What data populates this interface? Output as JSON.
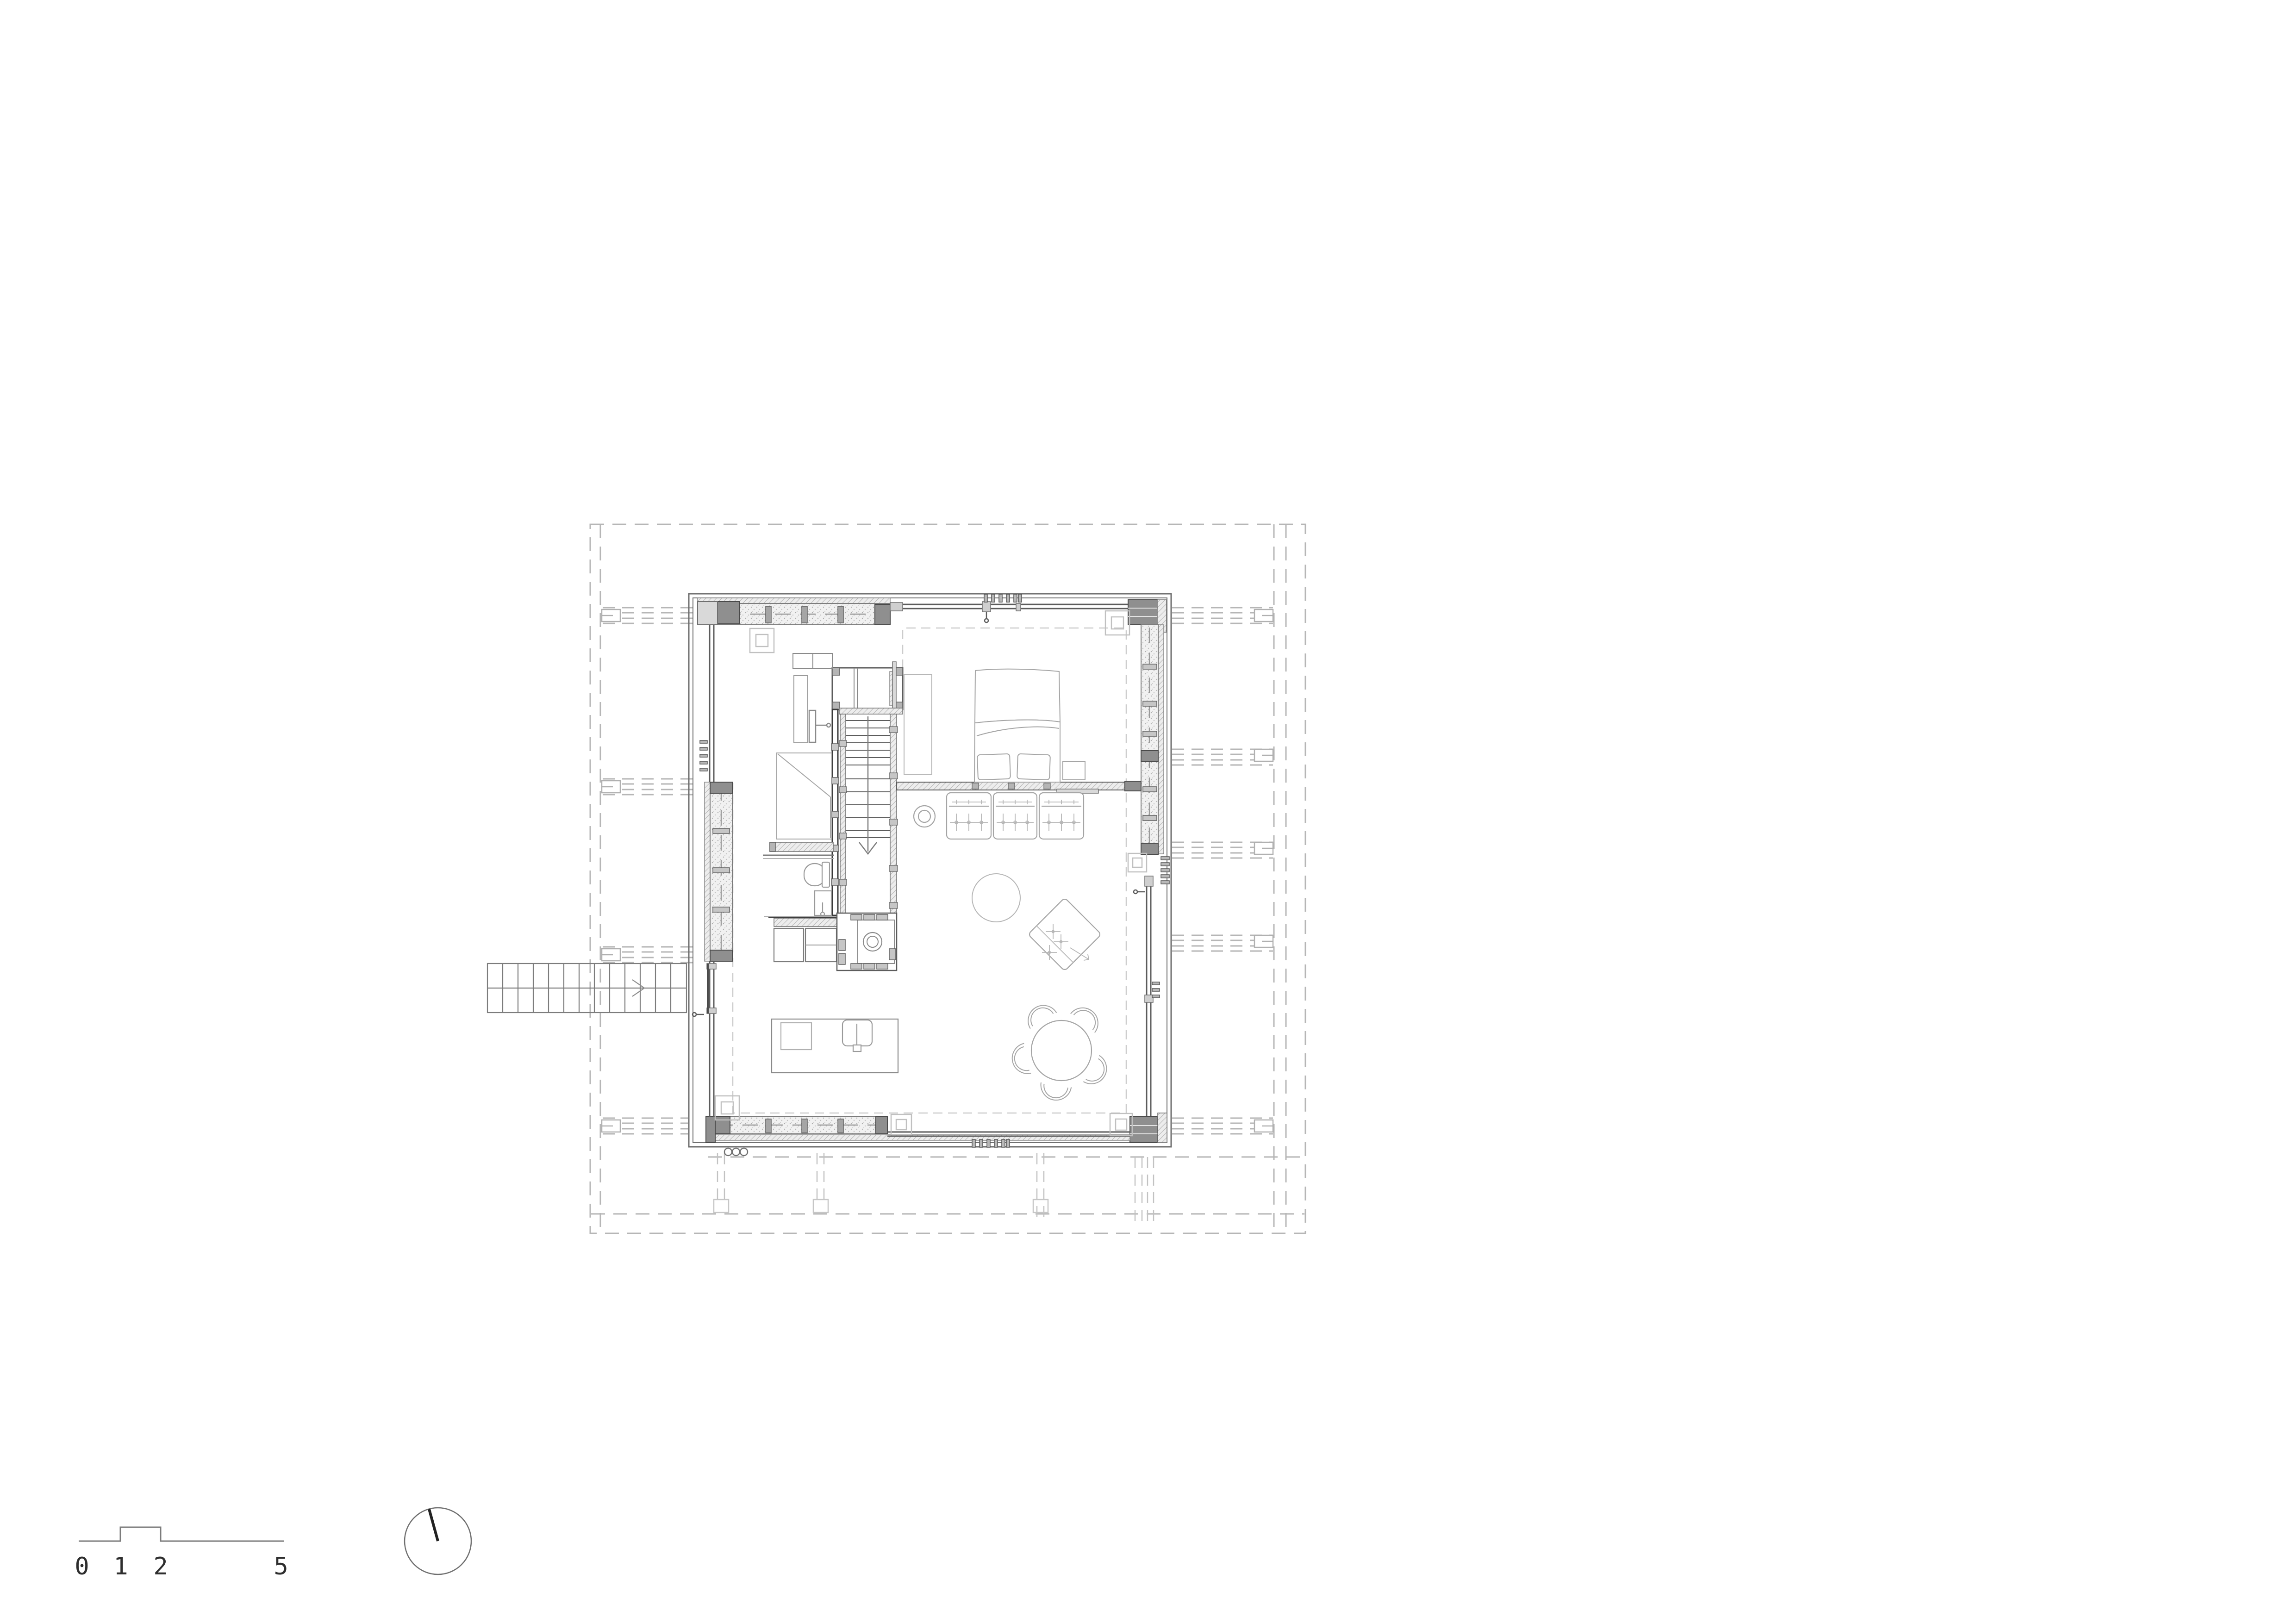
{
  "document": {
    "type": "architectural-floor-plan",
    "background": "#ffffff",
    "description": "Single-storey timber house floor plan with central stair core, bathroom block, two bed areas, sofa, dining table, masonry stove, external entry stair, dashed roof/foundation grid, scale bar and north indicator"
  },
  "scale_bar": {
    "labels": [
      "0",
      "1",
      "2",
      "5"
    ],
    "units": "m"
  },
  "north_indicator": {
    "type": "circle-with-needle",
    "needle_direction": "north-north-west"
  },
  "colors": {
    "background": "#ffffff",
    "line_dark": "#3f3f3f",
    "line_mid": "#8a8a8a",
    "line_light": "#b0b0b0",
    "dash_grid": "#b6b6b6",
    "dash_interior": "#cccccc",
    "wall_core_fill": "#f0f0f0",
    "cladding_fill": "#e9e9e9",
    "post_fill": "#8f8f8f",
    "stud_fill": "#c6c6c6",
    "furniture_line": "#9a9a9a",
    "furniture_light": "#b5b5b5"
  },
  "elements": [
    "roof-outline-dashed",
    "structural-beam-bands",
    "foundation-grid",
    "building-shell",
    "top-wall",
    "right-wall",
    "bottom-wall",
    "left-wall",
    "window-bands",
    "vent-grilles",
    "stair-core",
    "internal-stair-down-arrow",
    "wardrobe",
    "bathroom-door",
    "shower-room",
    "toilet",
    "wash-basin",
    "bench",
    "kitchen-counter",
    "masonry-stove",
    "bed",
    "pillows",
    "nightstand",
    "sofa-three-seat",
    "round-stool",
    "round-rug",
    "ottoman-diamond",
    "dining-table-round",
    "dining-chairs",
    "work-table",
    "work-chair",
    "external-entry-stair",
    "entry-door",
    "corner-markers",
    "service-circles",
    "scale-bar",
    "north-circle"
  ]
}
